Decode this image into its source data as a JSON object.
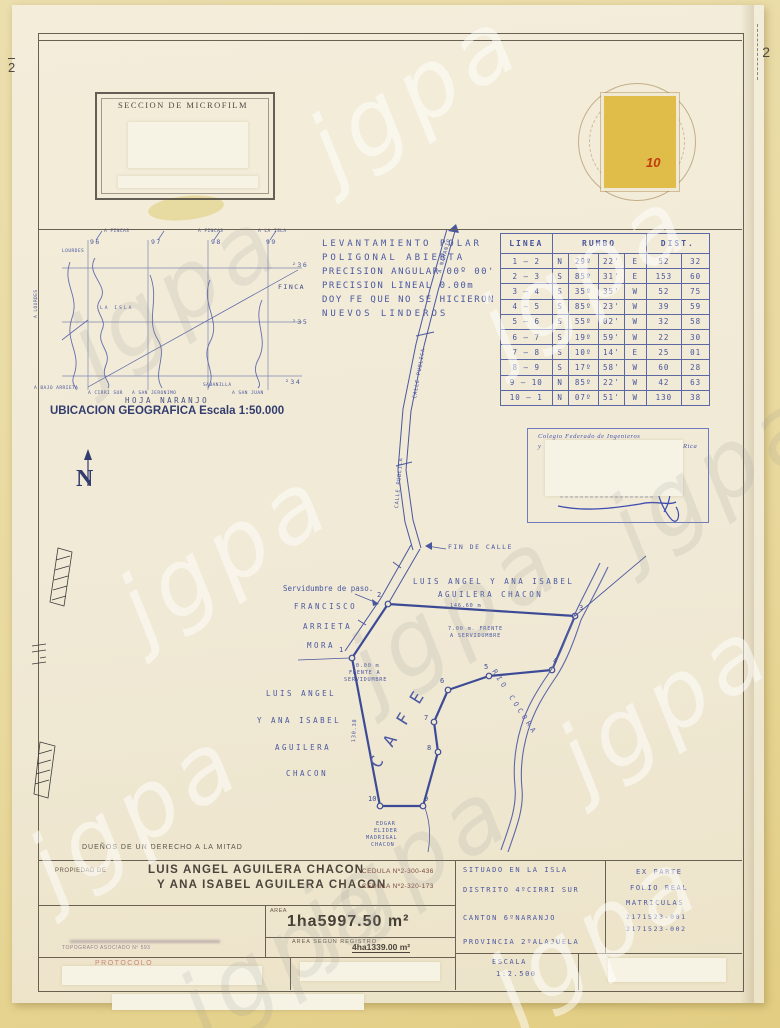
{
  "watermark": "jgpa",
  "header": {
    "microfilm": {
      "title": "SECCION DE MICROFILM",
      "left_number": "2",
      "right_number": "2"
    },
    "stamp_value": "10"
  },
  "location_map": {
    "caption": "UBICACION GEOGRAFICA Escala 1:50.000",
    "sheet": "HOJA NARANJO",
    "top_labels": [
      "A FINCAS",
      "A FINCAS",
      "A LA ISLA"
    ],
    "grid_x": [
      "96",
      "97",
      "98",
      "99"
    ],
    "grid_y": [
      "²36",
      "²35",
      "²34"
    ],
    "labels": {
      "lourdes": "LOURDES",
      "la_isla": "LA ISLA",
      "finca": "FINCA",
      "a_lourdes": "A LOURDES",
      "a_bajo": "A BAJO ARRIETA",
      "a_cirri": "A CIRRI SUR",
      "a_san_jeronimo": "A SAN JERONIMO",
      "sabanilla": "SABANILLA",
      "a_san_juan": "A SAN JUAN"
    }
  },
  "survey_notes": [
    "LEVANTAMIENTO POLAR",
    "POLIGONAL ABIERTA",
    "PRECISION ANGULAR 00º 00'",
    "PRECISION LINEAL 0.00m",
    "DOY FE QUE NO SE HICIERON",
    "NUEVOS LINDEROS"
  ],
  "bearings_table": {
    "col_linea": "LINEA",
    "col_rumbo": "RUMBO",
    "col_dist": "DIST.",
    "rows": [
      [
        "1 – 2",
        "N",
        "29º",
        "22'",
        "E",
        "52",
        "32"
      ],
      [
        "2 – 3",
        "S",
        "85º",
        "31'",
        "E",
        "153",
        "60"
      ],
      [
        "3 – 4",
        "S",
        "35º",
        "35'",
        "W",
        "52",
        "75"
      ],
      [
        "4 – 5",
        "S",
        "85º",
        "23'",
        "W",
        "39",
        "59"
      ],
      [
        "5 – 6",
        "S",
        "55º",
        "02'",
        "W",
        "32",
        "58"
      ],
      [
        "6 – 7",
        "S",
        "19º",
        "59'",
        "W",
        "22",
        "30"
      ],
      [
        "7 – 8",
        "S",
        "10º",
        "14'",
        "E",
        "25",
        "01"
      ],
      [
        "8 – 9",
        "S",
        "17º",
        "58'",
        "W",
        "60",
        "28"
      ],
      [
        "9 – 10",
        "N",
        "85º",
        "22'",
        "W",
        "42",
        "63"
      ],
      [
        "10 – 1",
        "N",
        "07º",
        "51'",
        "W",
        "130",
        "38"
      ]
    ]
  },
  "stamp_box": {
    "line1": "Colegio Federado de Ingenieros",
    "line2_left": "y",
    "line2_right": "Rica"
  },
  "plot": {
    "vertices": [
      "1",
      "2",
      "3",
      "4",
      "5",
      "6",
      "7",
      "8",
      "9",
      "10"
    ],
    "north_letter": "N",
    "fin_de_calle": "FIN DE CALLE",
    "a_naranjo": "A NARANJO",
    "calle_publica": "CALLE PUBLICA",
    "servidumbre": "Servidumbre de paso.",
    "owner_north_1": "LUIS ANGEL Y ANA ISABEL",
    "owner_north_2": "AGUILERA CHACON",
    "dim_2_3": "146.60 m",
    "frente_7_1": "7.00 m. FRENTE",
    "frente_7_2": "A SERVIDUMBRE",
    "frente_10_1": "10.00 m",
    "frente_10_2": "FRENTE A",
    "frente_10_3": "SERVIDUMBRE",
    "west_neighbor": [
      "FRANCISCO",
      "ARRIETA",
      "MORA"
    ],
    "owner_west": [
      "LUIS ANGEL",
      "Y ANA ISABEL",
      "AGUILERA",
      "CHACON"
    ],
    "dim_10_1": "130.38",
    "crop": "CAFE",
    "river": "RIO COCORA",
    "south_neighbor": [
      "EDGAR",
      "ELIDER",
      "MADRIGAL",
      "CHACON"
    ],
    "duenos": "DUEÑOS DE UN DERECHO A LA MITAD"
  },
  "footer": {
    "propiedad_label": "PROPIEDAD DE",
    "owner1": "LUIS ANGEL AGUILERA CHACON",
    "cedula1": "CEDULA Nº2-300-436",
    "owner2": "Y ANA ISABEL AGUILERA CHACON",
    "cedula2": "CEDULA Nº2-320-173",
    "area_label": "AREA",
    "area_value": "1ha5997.50 m²",
    "registro_label": "AREA SEGUN REGISTRO",
    "registro_value": "4ha1339.00 m²",
    "situado": "SITUADO EN LA ISLA",
    "distrito": "DISTRITO 4ºCIRRI SUR",
    "canton": "CANTON 6ºNARANJO",
    "provincia": "PROVINCIA 2ºALAJUELA",
    "ex_parte": "EX PARTE",
    "folio_real": "FOLIO REAL",
    "matriculas": "MATRICULAS",
    "matricula_1": "2171523-001",
    "matricula_2": "2171523-002",
    "escala_label": "ESCALA",
    "escala_value": "1:2.500",
    "surveyor": "TOPOGRAFO ASOCIADO Nº 593",
    "protocolo": "PROTOCOLO"
  }
}
